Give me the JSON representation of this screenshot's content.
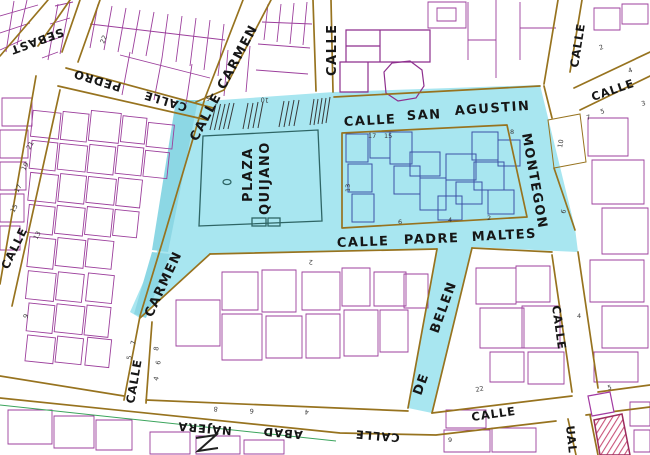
{
  "map": {
    "highlighted_area_color": "#A8E6F0",
    "highlight_band_color": "#8CD7E4",
    "parcel_line_color": "#9C3F9C",
    "street_edge_color": "#97731F",
    "highlighted_parcel_line_color": "#3D52A6",
    "street_labels": {
      "sebastian": "SEBAST",
      "pedro_calle": "CALLE",
      "pedro": "PEDRO",
      "carmen_top": "CALLE CARMEN",
      "left_calle": "CALLE",
      "top_center_calle": "CALLE",
      "san_agustin_calle": "CALLE",
      "san_agustin_san": "SAN",
      "san_agustin": "AGUSTIN",
      "montegon": "MONTEGON",
      "right_top_calle": "CALLE",
      "right_diag_calle": "CALLE",
      "padre_calle": "CALLE",
      "padre": "PADRE",
      "maltes": "MALTES",
      "carmen_mid": "CARMEN",
      "carmen_low_calle": "CALLE",
      "belen_de": "DE",
      "belen": "BELEN",
      "right_vert_calle": "CALLE",
      "najera_calle": "CALLE",
      "najera_abad": "ABAD",
      "najera": "NAJERA",
      "bottom_right_calle": "CALLE",
      "pascual_partial": "UAL"
    },
    "place_labels": {
      "plaza_line1": "PLAZA",
      "plaza_line2": "QUIJANO"
    },
    "parcel_numbers": [
      "22",
      "21",
      "19",
      "17",
      "15",
      "13",
      "5",
      "10",
      "17",
      "15",
      "8",
      "6",
      "4",
      "2",
      "2",
      "4",
      "3",
      "5",
      "7",
      "10",
      "6",
      "9",
      "8",
      "6",
      "4",
      "7",
      "5",
      "2",
      "22",
      "9",
      "5",
      "8",
      "6",
      "4",
      "13",
      "4"
    ]
  }
}
